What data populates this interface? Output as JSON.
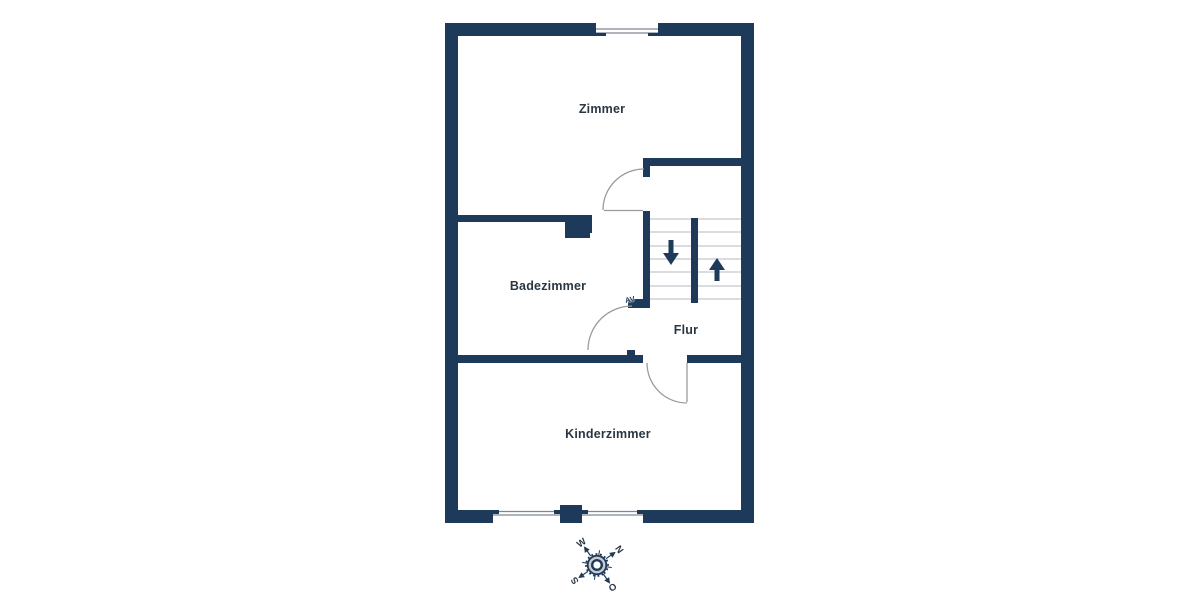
{
  "plan": {
    "rooms": [
      {
        "id": "zimmer",
        "label": "Zimmer"
      },
      {
        "id": "badezimmer",
        "label": "Badezimmer"
      },
      {
        "id": "flur",
        "label": "Flur"
      },
      {
        "id": "kinderzimmer",
        "label": "Kinderzimmer"
      }
    ],
    "stair_marker": "AV"
  },
  "compass": {
    "rotation_deg": 55,
    "points": [
      {
        "dir": "north",
        "label": "N"
      },
      {
        "dir": "east",
        "label": "O"
      },
      {
        "dir": "south",
        "label": "S"
      },
      {
        "dir": "west",
        "label": "W"
      }
    ]
  },
  "theme": {
    "wall": "#1e3a5a",
    "label": "#2a3742",
    "door-line": "#9b9b9b",
    "tread": "#c3c7cc",
    "window-line": "#7d8790",
    "compass-ring": "#c6cad0",
    "bg": "#ffffff"
  }
}
